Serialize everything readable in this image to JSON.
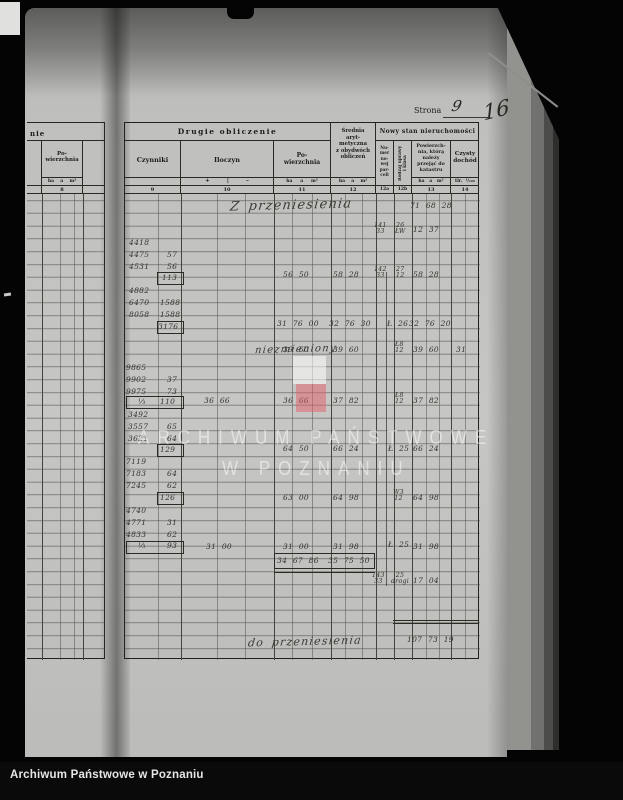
{
  "photo_footer": {
    "label": "Archiwum Państwowe w Poznaniu"
  },
  "page_header": {
    "strona_label": "Strona",
    "strona_value": "9",
    "folio": "16"
  },
  "watermark": {
    "line1": "ARCHIWUM PAŃSTWOWE",
    "line2": "W POZNANIU"
  },
  "left_table": {
    "header_fragment": "nie",
    "col_powierzchnia": "Po-\nwierzchnia",
    "units": "ha    a    m²",
    "col_num": "8"
  },
  "table": {
    "sections": {
      "drugie": "Drugie obliczenie",
      "nowy": "Nowy stan nieruchomości"
    },
    "cols": {
      "czynniki": "Czynniki",
      "iloczyn": "Iloczyn",
      "signs": "+         |         –",
      "powierzchnia": "Po-\nwierzchnia",
      "srednia": "Średnia\naryt-\nmetyczna\nz obydwóch\nobliczeń",
      "numer": "Nu-\nmer\nno-\nwej\npar-\nceli",
      "rodzaj": "Rodzaj uprawy\ni klasa",
      "przejac": "Powierzch-\nnia, którą\nnależy\nprzejąć do\nkatastru",
      "dochod": "Czysty\ndochód",
      "units_11": "ha     a     m²",
      "units_12": "ha    a    m²",
      "units_13": "ha   a   m²",
      "units_tlr": "tlr.  ¹/₁₀₀",
      "nums": [
        "9",
        "10",
        "11",
        "12",
        "12a",
        "12b",
        "13",
        "14"
      ]
    },
    "entries": [
      {
        "t": "Z przeniesienia",
        "x": 230,
        "y": 199,
        "c": "cur",
        "fs": 13
      },
      {
        "t": "niezmieniony",
        "x": 255,
        "y": 345,
        "c": "cur",
        "fs": 10
      },
      {
        "t": "do przeniesienia",
        "x": 248,
        "y": 636,
        "c": "cur",
        "fs": 11
      },
      {
        "t": "71 68 28",
        "x": 410,
        "y": 202
      },
      {
        "t": "12 37",
        "x": 413,
        "y": 226
      },
      {
        "t": "58 28",
        "x": 413,
        "y": 271
      },
      {
        "t": "32 76 20",
        "x": 409,
        "y": 320
      },
      {
        "t": "39 60",
        "x": 413,
        "y": 346
      },
      {
        "t": "37 82",
        "x": 413,
        "y": 397
      },
      {
        "t": "66 24",
        "x": 413,
        "y": 445
      },
      {
        "t": "64 98",
        "x": 413,
        "y": 494
      },
      {
        "t": "31 98",
        "x": 413,
        "y": 543
      },
      {
        "t": "17 04",
        "x": 413,
        "y": 577
      },
      {
        "t": "107 73 19",
        "x": 407,
        "y": 636
      },
      {
        "t": "31",
        "x": 456,
        "y": 346
      },
      {
        "t": "58 28",
        "x": 333,
        "y": 271
      },
      {
        "t": "32 76 30",
        "x": 329,
        "y": 320
      },
      {
        "t": "39 60",
        "x": 333,
        "y": 346
      },
      {
        "t": "37 82",
        "x": 333,
        "y": 397
      },
      {
        "t": "66 24",
        "x": 333,
        "y": 445
      },
      {
        "t": "64 98",
        "x": 333,
        "y": 494
      },
      {
        "t": "31 98",
        "x": 333,
        "y": 543
      },
      {
        "t": "35 75 50",
        "x": 328,
        "y": 557
      },
      {
        "t": "56 50",
        "x": 283,
        "y": 271
      },
      {
        "t": "31 76 00",
        "x": 277,
        "y": 320
      },
      {
        "t": "39 60",
        "x": 283,
        "y": 346
      },
      {
        "t": "36 66",
        "x": 283,
        "y": 397
      },
      {
        "t": "64 50",
        "x": 283,
        "y": 445
      },
      {
        "t": "63 00",
        "x": 283,
        "y": 494
      },
      {
        "t": "31 00",
        "x": 283,
        "y": 543
      },
      {
        "t": "34 67 86",
        "x": 277,
        "y": 557
      },
      {
        "t": "36 66",
        "x": 204,
        "y": 397
      },
      {
        "t": "31 00",
        "x": 206,
        "y": 543
      },
      {
        "t": "141\n33",
        "x": 374,
        "y": 223,
        "c": "frac"
      },
      {
        "t": "142\n33",
        "x": 374,
        "y": 267,
        "c": "frac"
      },
      {
        "t": "143\n33",
        "x": 372,
        "y": 573,
        "c": "frac"
      },
      {
        "t": "26\nŁW",
        "x": 395,
        "y": 223,
        "c": "frac"
      },
      {
        "t": "27\n12",
        "x": 396,
        "y": 267,
        "c": "frac"
      },
      {
        "t": "Ł 26",
        "x": 387,
        "y": 320
      },
      {
        "t": "Ł8\n12",
        "x": 395,
        "y": 342,
        "c": "frac"
      },
      {
        "t": "Ł8\n12",
        "x": 395,
        "y": 393,
        "c": "frac"
      },
      {
        "t": "Ł 25",
        "x": 388,
        "y": 445
      },
      {
        "t": "W3\n12",
        "x": 393,
        "y": 490,
        "c": "frac"
      },
      {
        "t": "Ł 25",
        "x": 388,
        "y": 541
      },
      {
        "t": "25\ndrogi",
        "x": 391,
        "y": 573,
        "c": "frac"
      },
      {
        "t": "4418",
        "x": 129,
        "y": 239
      },
      {
        "t": "4475",
        "x": 129,
        "y": 251
      },
      {
        "t": "57",
        "x": 167,
        "y": 251
      },
      {
        "t": "4531",
        "x": 129,
        "y": 263
      },
      {
        "t": "56",
        "x": 167,
        "y": 263
      },
      {
        "t": "113",
        "x": 162,
        "y": 274
      },
      {
        "t": "4882",
        "x": 129,
        "y": 287
      },
      {
        "t": "6470",
        "x": 129,
        "y": 299
      },
      {
        "t": "1588",
        "x": 160,
        "y": 299
      },
      {
        "t": "8058",
        "x": 129,
        "y": 311
      },
      {
        "t": "1588",
        "x": 160,
        "y": 311
      },
      {
        "t": "3176",
        "x": 158,
        "y": 323
      },
      {
        "t": "9865",
        "x": 126,
        "y": 364
      },
      {
        "t": "9902",
        "x": 126,
        "y": 376
      },
      {
        "t": "37",
        "x": 167,
        "y": 376
      },
      {
        "t": "9975",
        "x": 126,
        "y": 388
      },
      {
        "t": "73",
        "x": 167,
        "y": 388
      },
      {
        "t": "⅓",
        "x": 138,
        "y": 398
      },
      {
        "t": "110",
        "x": 160,
        "y": 398
      },
      {
        "t": "3492",
        "x": 128,
        "y": 411
      },
      {
        "t": "3557",
        "x": 128,
        "y": 423
      },
      {
        "t": "65",
        "x": 167,
        "y": 423
      },
      {
        "t": "3621",
        "x": 128,
        "y": 435
      },
      {
        "t": "64",
        "x": 167,
        "y": 435
      },
      {
        "t": "129",
        "x": 160,
        "y": 446
      },
      {
        "t": "7119",
        "x": 126,
        "y": 458
      },
      {
        "t": "7183",
        "x": 126,
        "y": 470
      },
      {
        "t": "64",
        "x": 167,
        "y": 470
      },
      {
        "t": "7245",
        "x": 126,
        "y": 482
      },
      {
        "t": "62",
        "x": 167,
        "y": 482
      },
      {
        "t": "126",
        "x": 160,
        "y": 494
      },
      {
        "t": "4740",
        "x": 126,
        "y": 507
      },
      {
        "t": "4771",
        "x": 126,
        "y": 519
      },
      {
        "t": "31",
        "x": 167,
        "y": 519
      },
      {
        "t": "4833",
        "x": 126,
        "y": 531
      },
      {
        "t": "62",
        "x": 167,
        "y": 531
      },
      {
        "t": "⅓",
        "x": 138,
        "y": 542
      },
      {
        "t": "93",
        "x": 167,
        "y": 542
      }
    ]
  }
}
